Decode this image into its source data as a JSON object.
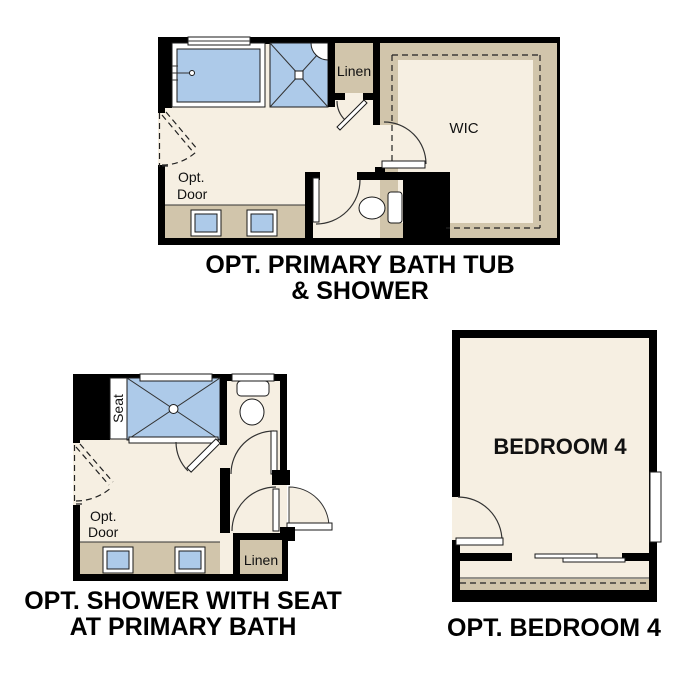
{
  "colors": {
    "wall": "#000000",
    "floor": "#f6efe2",
    "fixture": "#adcae9",
    "tan": "#d1c5ab",
    "line": "#333333"
  },
  "plans": {
    "p1": {
      "title_line1": "OPT. PRIMARY BATH TUB",
      "title_line2": "& SHOWER",
      "labels": {
        "linen": "Linen",
        "wic": "WIC",
        "opt_line1": "Opt.",
        "opt_line2": "Door"
      }
    },
    "p2": {
      "title_line1": "OPT. SHOWER WITH SEAT",
      "title_line2": "AT PRIMARY BATH",
      "labels": {
        "seat": "Seat",
        "linen": "Linen",
        "opt_line1": "Opt.",
        "opt_line2": "Door"
      }
    },
    "p3": {
      "title": "OPT. BEDROOM 4",
      "labels": {
        "room": "BEDROOM 4"
      }
    }
  }
}
